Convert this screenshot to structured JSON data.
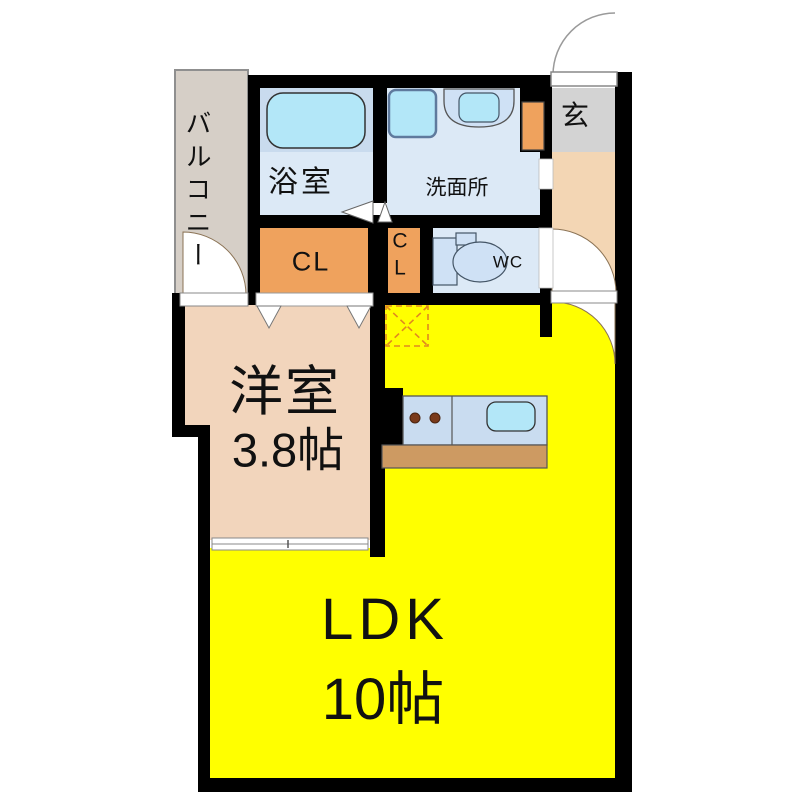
{
  "plan_title": "1K/1LDK apartment floor plan",
  "colors": {
    "wall": "#000000",
    "ldk_yellow": "#ffff00",
    "room_tan": "#f2d5bc",
    "hall_peach": "#f3d6b4",
    "balcony_beige": "#d6cfc7",
    "genkan_gray": "#d3d3d3",
    "closet_orange": "#efa25d",
    "wet_room_blue": "#dce9f6",
    "tub_surround_blue": "#c9dbee",
    "fixture_blue": "#cfe1f5",
    "water_cyan": "#b3e7f8",
    "counter_blue": "#c9dcf0",
    "counter_brown": "#cd9a62",
    "burner_brown": "#7a3a1a",
    "fridge_dash_orange": "#e08820"
  },
  "rooms": {
    "balcony": {
      "label": "バルコニー"
    },
    "bathroom": {
      "label": "浴室"
    },
    "washroom": {
      "label": "洗面所"
    },
    "entrance": {
      "label": "玄"
    },
    "closet_main": {
      "label": "CL"
    },
    "closet_small": {
      "line1": "C",
      "line2": "L"
    },
    "toilet": {
      "label": "WC"
    },
    "western_room": {
      "name": "洋室",
      "size": "3.8帖"
    },
    "ldk": {
      "name": "LDK",
      "size": "10帖"
    }
  }
}
